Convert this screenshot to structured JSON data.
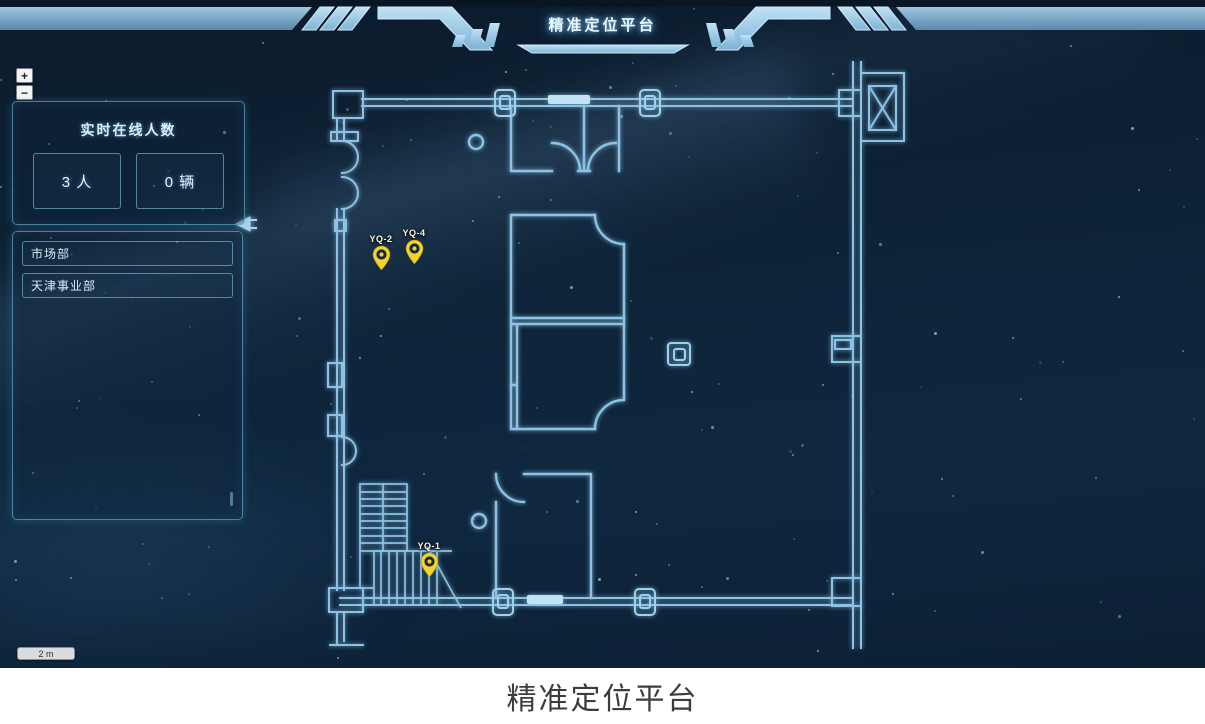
{
  "header": {
    "title": "精准定位平台"
  },
  "caption": {
    "text": "精准定位平台"
  },
  "zoom_control": {
    "zoom_in": "+",
    "zoom_out": "−"
  },
  "stats_panel": {
    "title": "实时在线人数",
    "people": {
      "value": "3 人"
    },
    "vehicles": {
      "value": "0 辆"
    }
  },
  "department_panel": {
    "items": [
      {
        "label": "市场部"
      },
      {
        "label": "天津事业部"
      }
    ]
  },
  "map": {
    "scale_label": "2 m",
    "pin_color": "#f2d42c",
    "pins": [
      {
        "id": "YQ-2",
        "label": "YQ-2",
        "x": 381,
        "y": 270
      },
      {
        "id": "YQ-4",
        "label": "YQ-4",
        "x": 414,
        "y": 264
      },
      {
        "id": "YQ-1",
        "label": "YQ-1",
        "x": 429,
        "y": 577
      }
    ]
  },
  "colors": {
    "background": "#0d2236",
    "wall_line": "#8cc3e4",
    "panel_border": "#5fa0c3",
    "accent_text": "#d8eef8",
    "header_band": "#8fbedd"
  }
}
